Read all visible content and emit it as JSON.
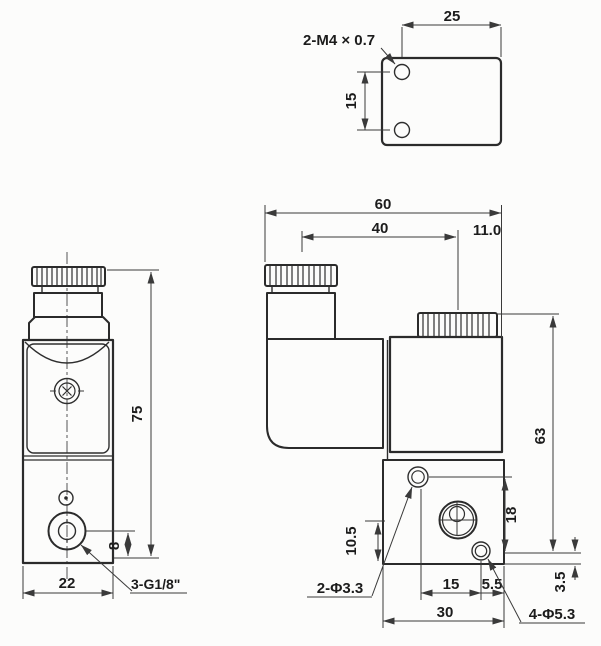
{
  "drawing": {
    "views": {
      "top": {
        "dim_width": "25",
        "dim_hole_pitch": "15",
        "thread_label": "2-M4 × 0.7"
      },
      "front": {
        "dim_height": "75",
        "dim_port_offset": "8",
        "dim_width": "22",
        "port_label": "3-G1/8\""
      },
      "side": {
        "dim_overall_width": "60",
        "dim_cap_center": "40",
        "dim_right_edge": "11.0",
        "dim_body_height": "63",
        "dim_hole_gap": "18",
        "dim_port_height": "10.5",
        "dim_hole_bottom": "3.5",
        "dim_hole_pitch": "15",
        "dim_hole_edge": "5.5",
        "dim_base_width": "30",
        "pilot_hole_label": "2-Φ3.3",
        "mount_hole_label": "4-Φ5.3"
      }
    },
    "colors": {
      "line": "#2b2b2b",
      "dimension_line": "#3a3a3a",
      "background": "#fcfcfb"
    }
  }
}
